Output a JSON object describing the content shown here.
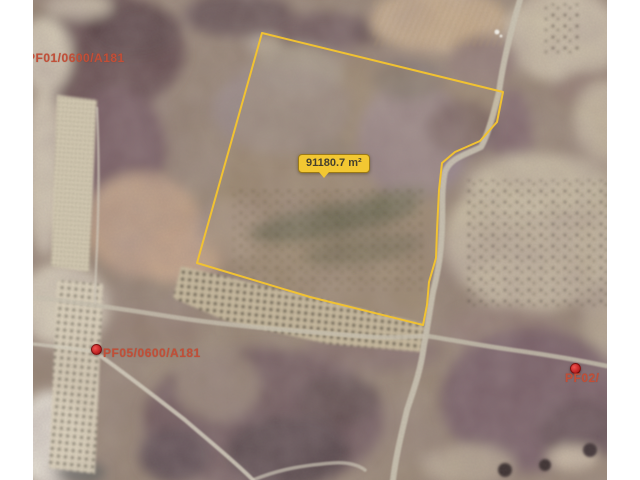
{
  "map": {
    "title": "satellite-parcel-viewer",
    "area_label": {
      "text": "91180.7 m²"
    },
    "parcel_labels": [
      {
        "id": "PF01/0600/A181"
      },
      {
        "id": "PF05/0600/A181"
      },
      {
        "id": "PF02/"
      }
    ],
    "markers": [
      {
        "icon": "red-location-dot"
      },
      {
        "icon": "red-location-dot"
      }
    ],
    "colors": {
      "parcel_outline": "#f1c232",
      "area_label_bg": "#f2c732",
      "area_label_border": "#9c7a16",
      "parcel_text": "#c14f38",
      "marker_red": "#c62828",
      "frame": "#ffffff"
    }
  }
}
